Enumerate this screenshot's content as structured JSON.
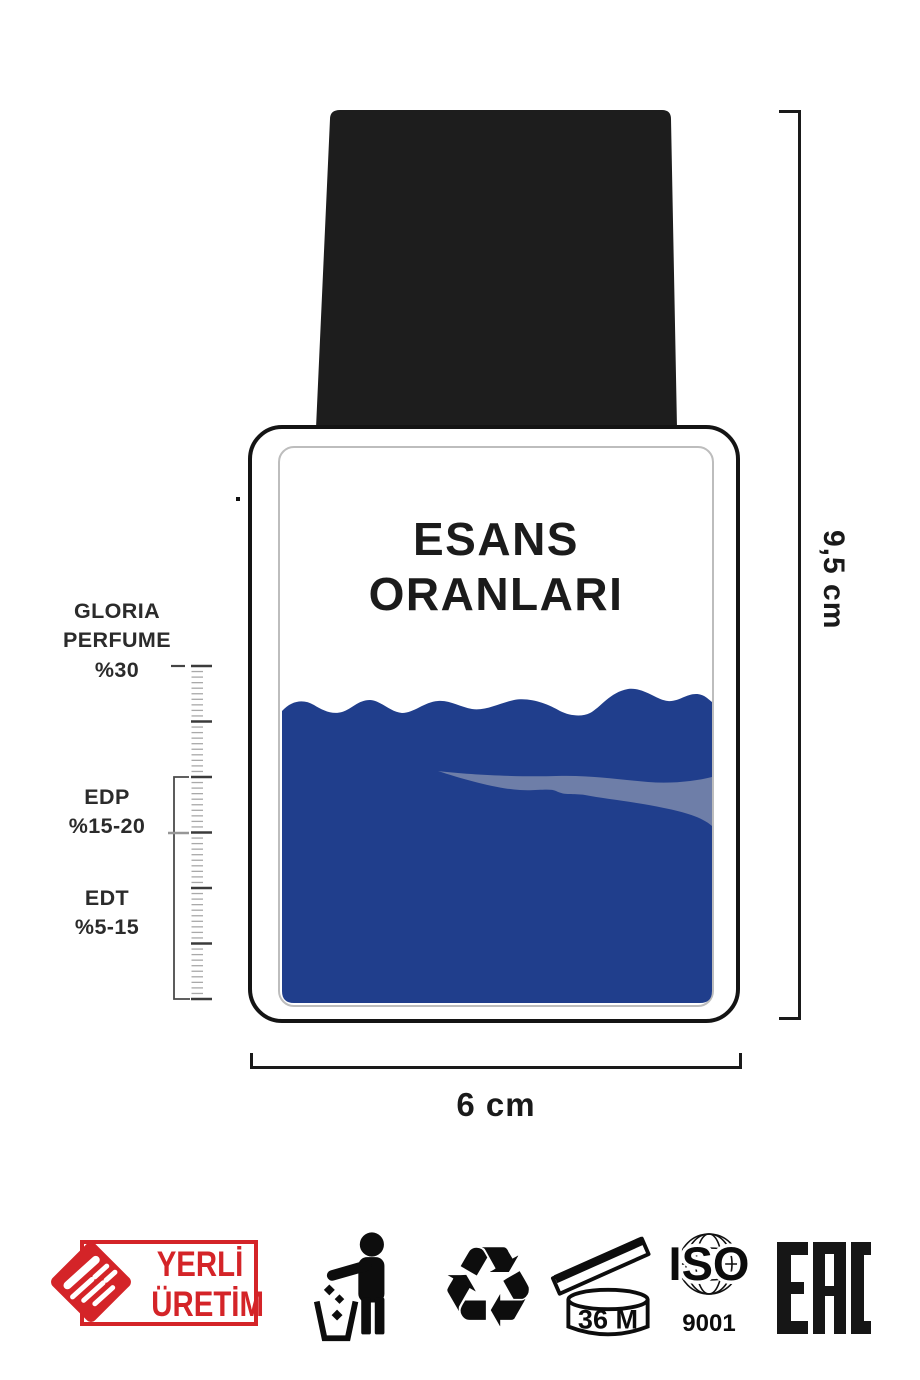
{
  "diagram": {
    "bottle_title": {
      "line1": "ESANS",
      "line2": "ORANLARI"
    },
    "scale_labels": {
      "gloria": [
        "GLORIA",
        "PERFUME",
        "%30"
      ],
      "edp": [
        "EDP",
        "%15-20"
      ],
      "edt": [
        "EDT",
        "%5-15"
      ]
    },
    "dimensions": {
      "height": "9,5 cm",
      "width": "6 cm"
    }
  },
  "footer": {
    "yerli_uretim": {
      "line1": "YERLİ",
      "line2": "ÜRETİM"
    },
    "recycle_glyph": "♻",
    "pao_label": "36 M",
    "iso": {
      "title": "ISO",
      "code": "9001"
    },
    "eac_label": "EAC"
  },
  "colors": {
    "liquid": "#203e8c",
    "liquid_highlight": "#6e7ea8",
    "cap": "#1d1d1d",
    "badge_red": "#d42428",
    "ink": "#1a1a1a"
  }
}
